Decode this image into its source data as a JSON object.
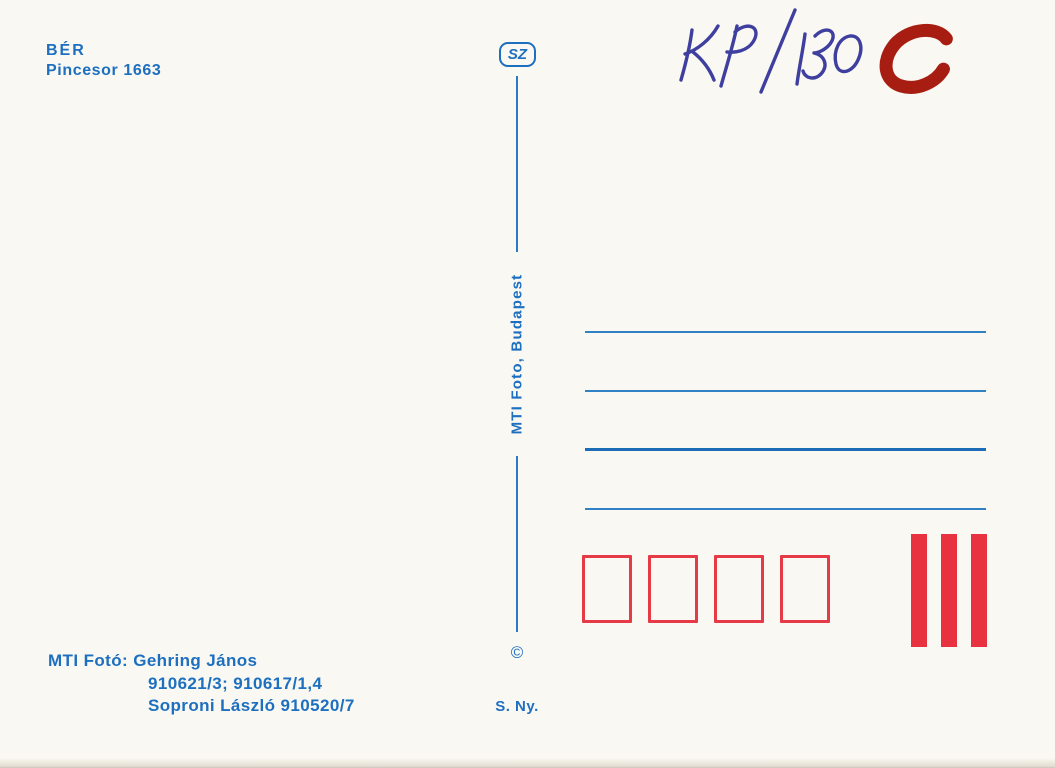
{
  "card": {
    "type": "postcard-back",
    "background_color": "#faf8f2"
  },
  "publisher_block": {
    "title": "BÉR",
    "subtitle": "Pincesor 1663"
  },
  "emblem": {
    "label": "SZ"
  },
  "divider": {
    "label": "MTI Foto, Budapest",
    "copyright_symbol": "©"
  },
  "printer": {
    "label": "S. Ny."
  },
  "credits": {
    "line1": "MTI Fotó: Gehring János",
    "line2": "910621/3; 910617/1,4",
    "line3": "Soproni László 910520/7"
  },
  "handwriting": {
    "code": "KP/130",
    "grade": "C",
    "pen_color": "#3e3f9f",
    "marker_color": "#a81d12"
  },
  "address_area": {
    "line_count": 4,
    "thin_line_color": "#3182c5",
    "thick_line_index": 3,
    "thick_line_color": "#1c6cb8"
  },
  "postcode_boxes": {
    "count": 4,
    "outline_color": "#e63a46"
  },
  "stamp_bars": {
    "count": 3,
    "fill_color": "#e8323f"
  },
  "colors": {
    "print_blue": "#1d6fc0",
    "red": "#e63a46"
  }
}
